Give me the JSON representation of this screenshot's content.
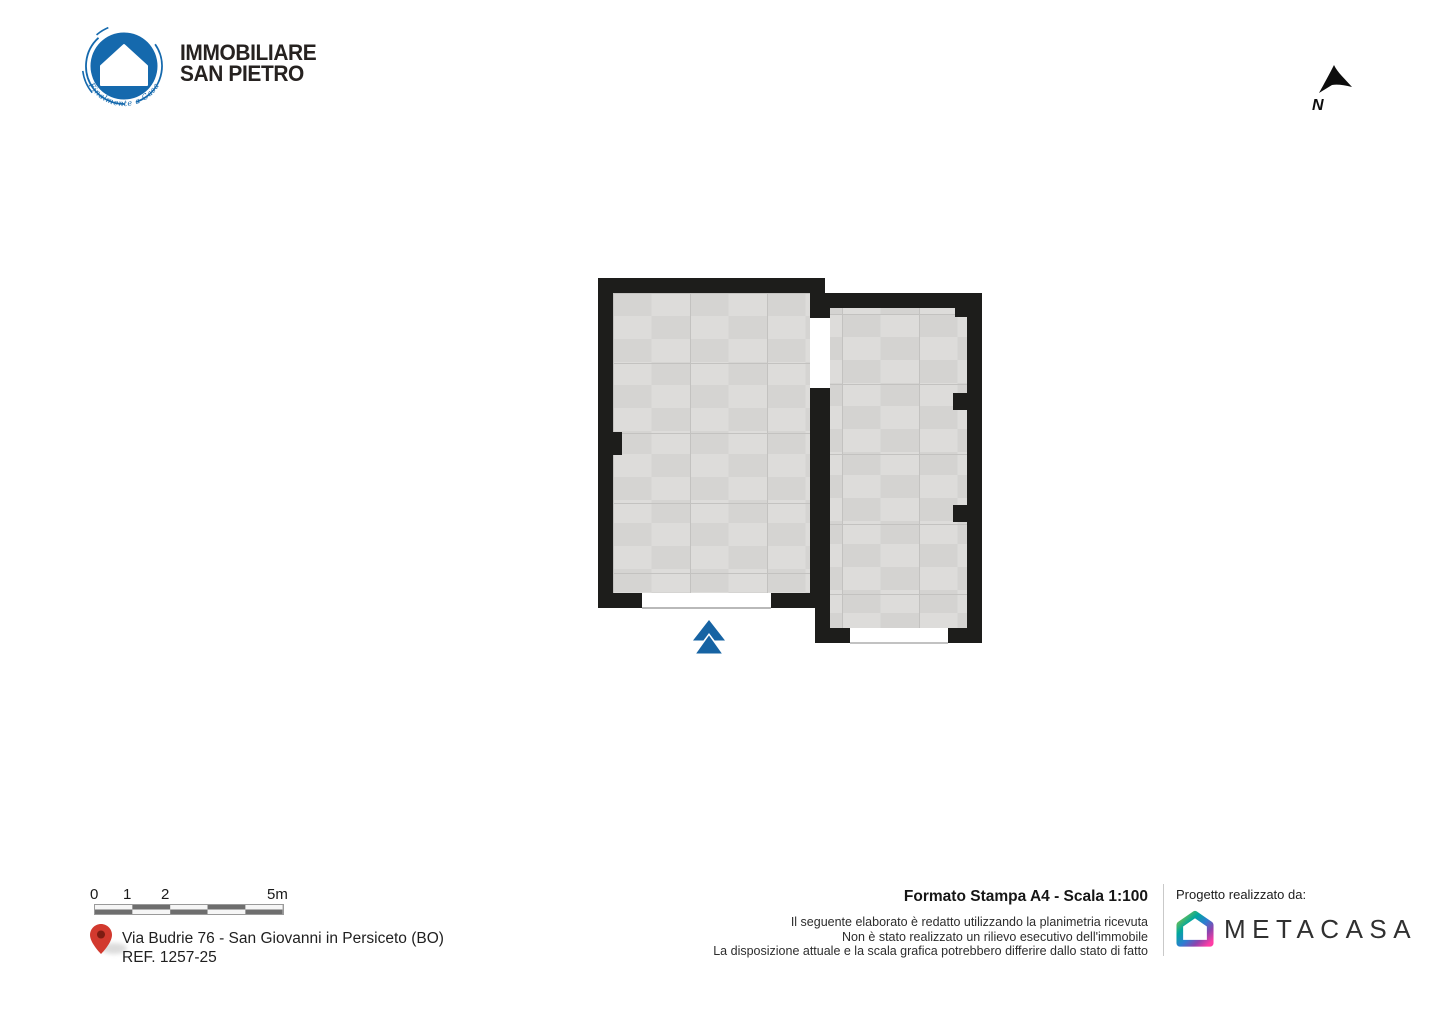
{
  "branding": {
    "agency": {
      "name_line1": "IMMOBILIARE",
      "name_line2": "SAN PIETRO",
      "tagline": "Finalmente a Casa",
      "brand_blue": "#1569ad"
    }
  },
  "compass": {
    "north_label": "N"
  },
  "floorplan": {
    "wall_color": "#1d1d1b",
    "floor_tile_color": "#d8d7d5",
    "entrance_arrow_color": "#1663a3",
    "room_labels": []
  },
  "footer": {
    "scalebar": {
      "tick_labels": [
        "0",
        "1",
        "2",
        "5m"
      ]
    },
    "address": {
      "line1": "Via Budrie 76 - San Giovanni in Persiceto (BO)",
      "line2": "REF. 1257-25",
      "pin_color": "#d2392e"
    },
    "print_info": {
      "title": "Formato Stampa A4 - Scala 1:100",
      "disclaimer_lines": [
        "Il seguente elaborato è redatto utilizzando la planimetria ricevuta",
        "Non è stato realizzato un rilievo esecutivo dell'immobile",
        "La disposizione attuale e la scala grafica potrebbero differire dallo stato di fatto"
      ]
    },
    "credits": {
      "label": "Progetto realizzato da:",
      "brand_name": "METACASA"
    }
  }
}
